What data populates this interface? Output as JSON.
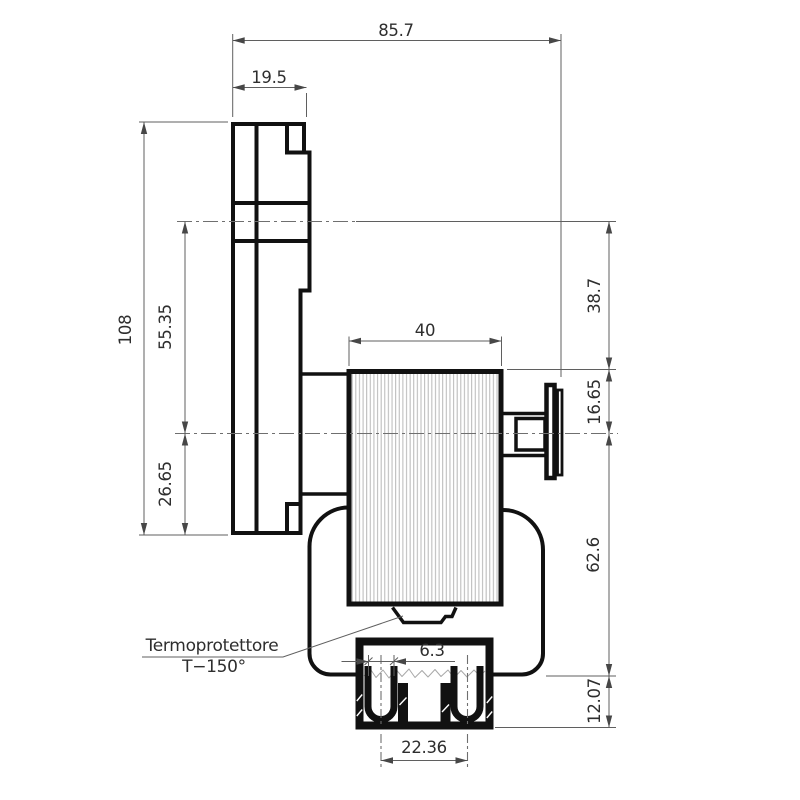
{
  "drawing": {
    "type": "technical-dimension-drawing",
    "subject": "gear-motor-side-view",
    "callout": {
      "line1": "Termoprotettore",
      "line2": "T−150°"
    },
    "dims": {
      "overall_depth": "85.7",
      "plate_thickness": "19.5",
      "plate_height": "108",
      "axis_to_axis": "55.35",
      "axis_to_plate_bottom": "26.65",
      "motor_length": "40",
      "output_axis_to_motor_top": "38.7",
      "motor_top_to_axis": "16.65",
      "axis_to_housing_bottom": "62.6",
      "housing_to_connector_bottom": "12.07",
      "terminal_width": "6.3",
      "terminal_spacing": "22.36"
    }
  },
  "colors": {
    "line": "#111111",
    "dimension": "#5f5f5f",
    "text": "#2e2e2e",
    "lamination": "#b5b5b5",
    "background": "#ffffff"
  }
}
